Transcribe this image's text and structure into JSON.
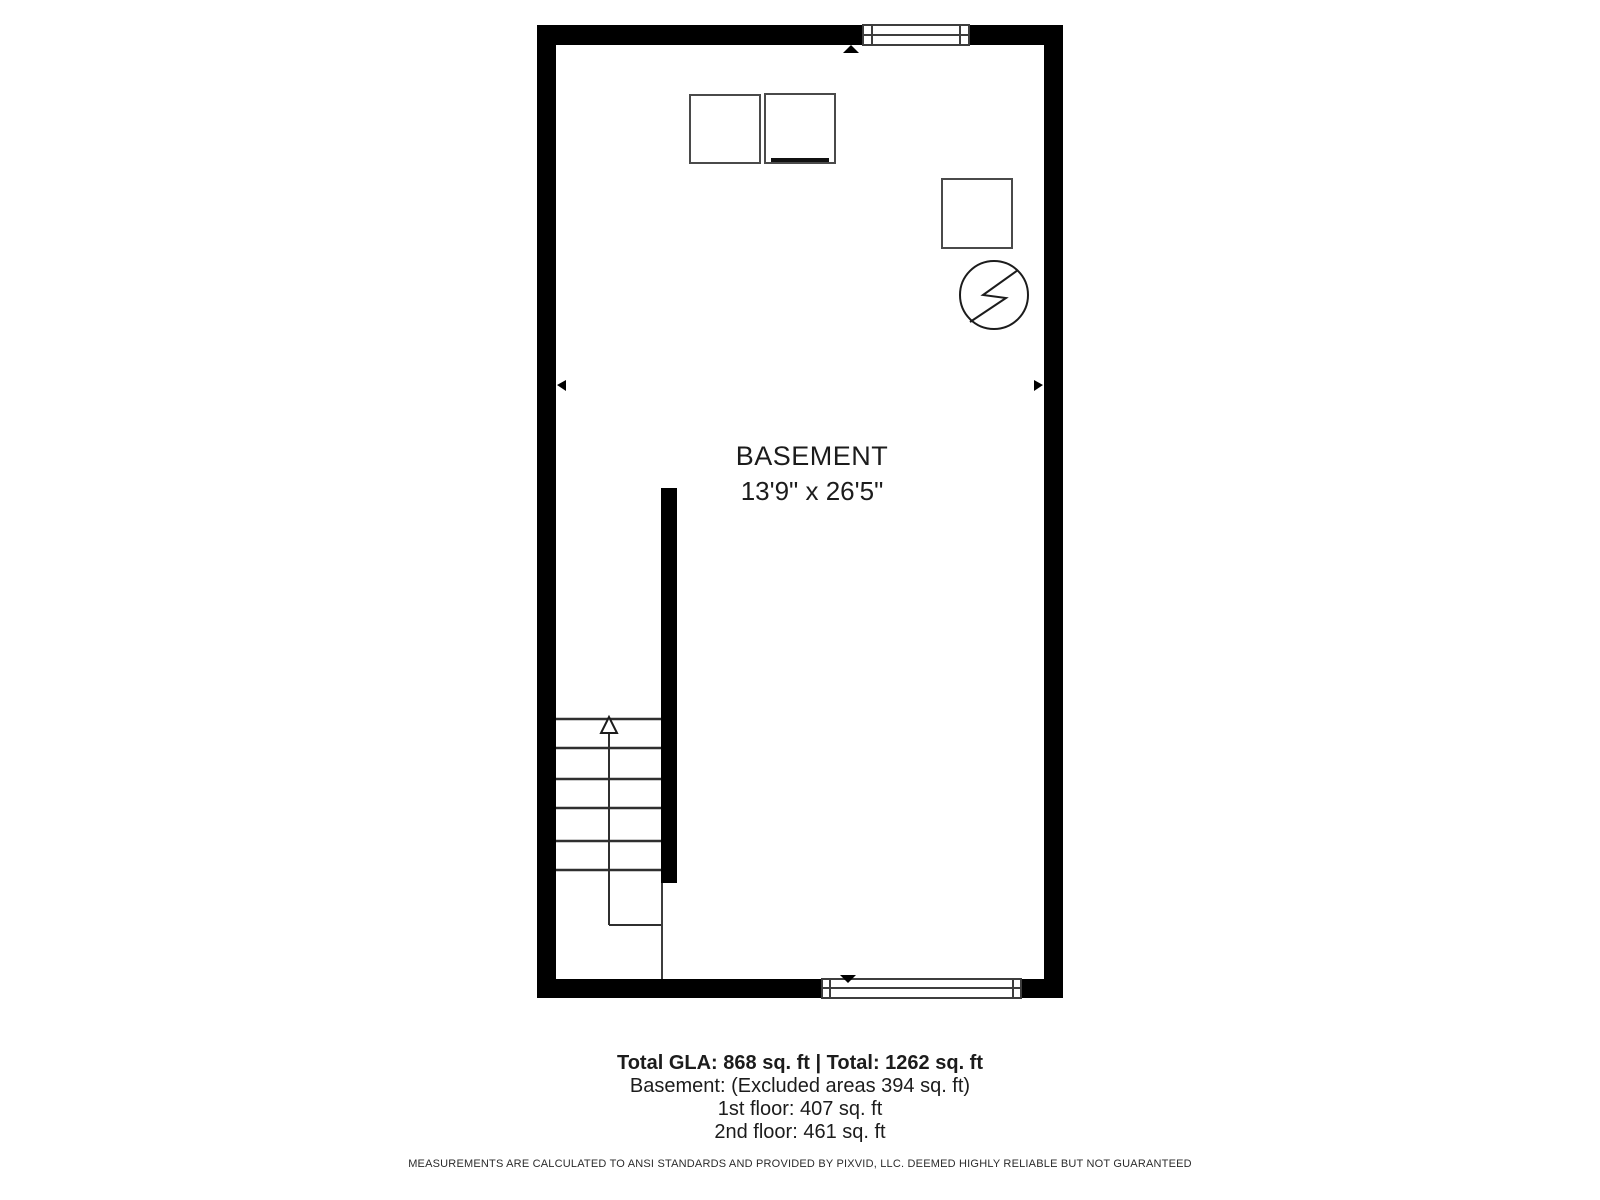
{
  "room": {
    "label": "BASEMENT",
    "dimensions": "13'9\" x 26'5\""
  },
  "summary": {
    "total": "Total GLA: 868 sq. ft | Total: 1262 sq. ft",
    "basement": "Basement: (Excluded areas 394 sq. ft)",
    "first_floor": "1st floor: 407 sq. ft",
    "second_floor": "2nd floor: 461 sq. ft"
  },
  "disclaimer": "MEASUREMENTS ARE CALCULATED TO ANSI STANDARDS AND PROVIDED BY PIXVID, LLC. DEEMED HIGHLY RELIABLE BUT NOT GUARANTEED",
  "colors": {
    "wall": "#000000",
    "thin_line": "#3d3d3d",
    "text": "#1c1c1c",
    "background": "#ffffff"
  }
}
